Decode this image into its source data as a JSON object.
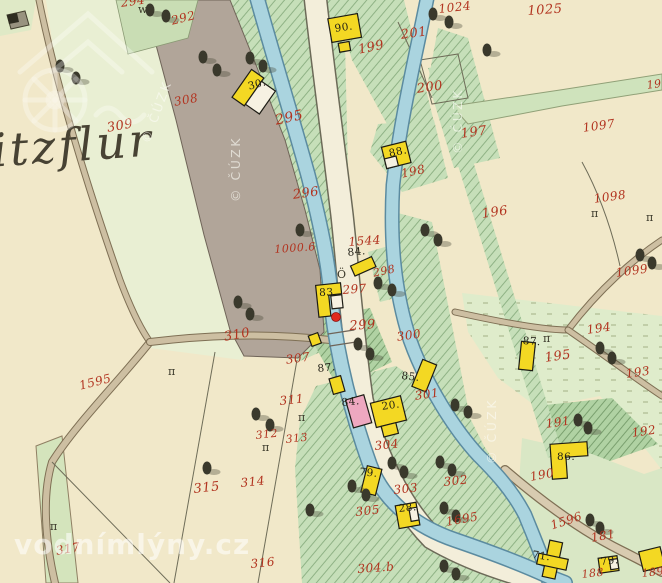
{
  "map": {
    "place_name": "itzflur"
  },
  "watermarks": {
    "copyright": "© ČÚZK",
    "site": "vodnímlýny.cz"
  },
  "colors": {
    "parcel_number_red": "#b23420",
    "house_number_black": "#211f15",
    "water": "#aad4df",
    "building_wood_yellow": "#f3d823",
    "building_masonry_pink": "#eea8c0",
    "road_gray": "#b1a599",
    "field_cream": "#f1e8c9",
    "garden_green": "#c6dfb9",
    "marker_red": "#e02a1e"
  },
  "parcel_labels": [
    {
      "text": "294",
      "x": 120,
      "y": -3,
      "r": -8
    },
    {
      "text": "292",
      "x": 170,
      "y": 15,
      "r": -14
    },
    {
      "text": "308",
      "x": 173,
      "y": 96,
      "r": -10
    },
    {
      "text": "309",
      "x": 106,
      "y": 122,
      "r": -10,
      "s": 13
    },
    {
      "text": "295",
      "x": 274,
      "y": 114,
      "r": -12,
      "s": 14
    },
    {
      "text": "296",
      "x": 292,
      "y": 189,
      "r": -8,
      "s": 13
    },
    {
      "text": "1544",
      "x": 348,
      "y": 236,
      "r": -4
    },
    {
      "text": "1000.6",
      "x": 274,
      "y": 244,
      "r": -4,
      "s": 11
    },
    {
      "text": "298",
      "x": 372,
      "y": 268,
      "r": -12,
      "s": 11
    },
    {
      "text": "297",
      "x": 342,
      "y": 284,
      "r": -4
    },
    {
      "text": "299",
      "x": 349,
      "y": 320,
      "r": -4,
      "s": 13
    },
    {
      "text": "300",
      "x": 396,
      "y": 331,
      "r": -8
    },
    {
      "text": "301",
      "x": 414,
      "y": 390,
      "r": -8
    },
    {
      "text": "310",
      "x": 223,
      "y": 331,
      "r": -10,
      "s": 13
    },
    {
      "text": "307",
      "x": 285,
      "y": 354,
      "r": -8
    },
    {
      "text": "311",
      "x": 279,
      "y": 395,
      "r": -6
    },
    {
      "text": "312",
      "x": 255,
      "y": 430,
      "r": -6,
      "s": 11
    },
    {
      "text": "313",
      "x": 285,
      "y": 434,
      "r": -6,
      "s": 11
    },
    {
      "text": "314",
      "x": 240,
      "y": 477,
      "r": -6
    },
    {
      "text": "315",
      "x": 193,
      "y": 483,
      "r": -6,
      "s": 13
    },
    {
      "text": "316",
      "x": 250,
      "y": 558,
      "r": -6
    },
    {
      "text": "317",
      "x": 55,
      "y": 545,
      "r": -10
    },
    {
      "text": "1595",
      "x": 78,
      "y": 380,
      "r": -14
    },
    {
      "text": "304",
      "x": 374,
      "y": 440,
      "r": -6
    },
    {
      "text": "303",
      "x": 393,
      "y": 484,
      "r": -6
    },
    {
      "text": "305",
      "x": 355,
      "y": 506,
      "r": -6
    },
    {
      "text": "302",
      "x": 443,
      "y": 476,
      "r": -6
    },
    {
      "text": "304.b",
      "x": 357,
      "y": 563,
      "r": -4
    },
    {
      "text": "1695",
      "x": 445,
      "y": 516,
      "r": -10
    },
    {
      "text": "1596",
      "x": 549,
      "y": 520,
      "r": -18
    },
    {
      "text": "181",
      "x": 590,
      "y": 532,
      "r": -10
    },
    {
      "text": "188",
      "x": 581,
      "y": 569,
      "r": -6,
      "s": 11
    },
    {
      "text": "189",
      "x": 641,
      "y": 568,
      "r": -6,
      "s": 11
    },
    {
      "text": "190",
      "x": 529,
      "y": 471,
      "r": -10
    },
    {
      "text": "191",
      "x": 545,
      "y": 418,
      "r": -8
    },
    {
      "text": "192",
      "x": 631,
      "y": 427,
      "r": -8
    },
    {
      "text": "193",
      "x": 625,
      "y": 368,
      "r": -8
    },
    {
      "text": "194",
      "x": 586,
      "y": 324,
      "r": -8
    },
    {
      "text": "195",
      "x": 544,
      "y": 352,
      "r": -8,
      "s": 13
    },
    {
      "text": "196",
      "x": 481,
      "y": 208,
      "r": -8,
      "s": 13
    },
    {
      "text": "197",
      "x": 460,
      "y": 128,
      "r": -8,
      "s": 13
    },
    {
      "text": "198",
      "x": 400,
      "y": 168,
      "r": -12
    },
    {
      "text": "199",
      "x": 357,
      "y": 44,
      "r": -12,
      "s": 13
    },
    {
      "text": "200",
      "x": 416,
      "y": 83,
      "r": -8,
      "s": 13
    },
    {
      "text": "201",
      "x": 400,
      "y": 29,
      "r": -8,
      "s": 13
    },
    {
      "text": "1024",
      "x": 438,
      "y": 3,
      "r": -6
    },
    {
      "text": "1025",
      "x": 527,
      "y": 5,
      "r": -4,
      "s": 13
    },
    {
      "text": "1097",
      "x": 582,
      "y": 122,
      "r": -8
    },
    {
      "text": "1098",
      "x": 593,
      "y": 193,
      "r": -8
    },
    {
      "text": "1099",
      "x": 615,
      "y": 267,
      "r": -8
    },
    {
      "text": "19",
      "x": 646,
      "y": 80,
      "r": -8,
      "s": 11
    }
  ],
  "house_labels": [
    {
      "text": "30.",
      "x": 247,
      "y": 82,
      "r": -15
    },
    {
      "text": "90.",
      "x": 334,
      "y": 24,
      "r": -8
    },
    {
      "text": "88.",
      "x": 388,
      "y": 149,
      "r": -12
    },
    {
      "text": "84.",
      "x": 347,
      "y": 248,
      "r": -6
    },
    {
      "text": "83.",
      "x": 319,
      "y": 288,
      "r": -2
    },
    {
      "text": "87.",
      "x": 317,
      "y": 364,
      "r": -6
    },
    {
      "text": "84.",
      "x": 341,
      "y": 398,
      "r": -6
    },
    {
      "text": "20.",
      "x": 381,
      "y": 402,
      "r": -8
    },
    {
      "text": "85.",
      "x": 402,
      "y": 371,
      "r": 6
    },
    {
      "text": "87.",
      "x": 523,
      "y": 336,
      "r": 4
    },
    {
      "text": "79.",
      "x": 360,
      "y": 467,
      "r": 6
    },
    {
      "text": "28.",
      "x": 398,
      "y": 504,
      "r": -6
    },
    {
      "text": "86.",
      "x": 557,
      "y": 452,
      "r": 0
    },
    {
      "text": "71.",
      "x": 533,
      "y": 550,
      "r": 8
    },
    {
      "text": "79.",
      "x": 600,
      "y": 557,
      "r": -6
    }
  ],
  "symbol_marks": [
    {
      "text": "w",
      "x": 138,
      "y": 4
    },
    {
      "text": "Ö",
      "x": 337,
      "y": 269
    },
    {
      "text": "π",
      "x": 168,
      "y": 366
    },
    {
      "text": "π",
      "x": 262,
      "y": 442
    },
    {
      "text": "π",
      "x": 298,
      "y": 412
    },
    {
      "text": "π",
      "x": 591,
      "y": 208
    },
    {
      "text": "π",
      "x": 646,
      "y": 212
    },
    {
      "text": "π",
      "x": 50,
      "y": 521
    },
    {
      "text": "π",
      "x": 543,
      "y": 333
    }
  ]
}
